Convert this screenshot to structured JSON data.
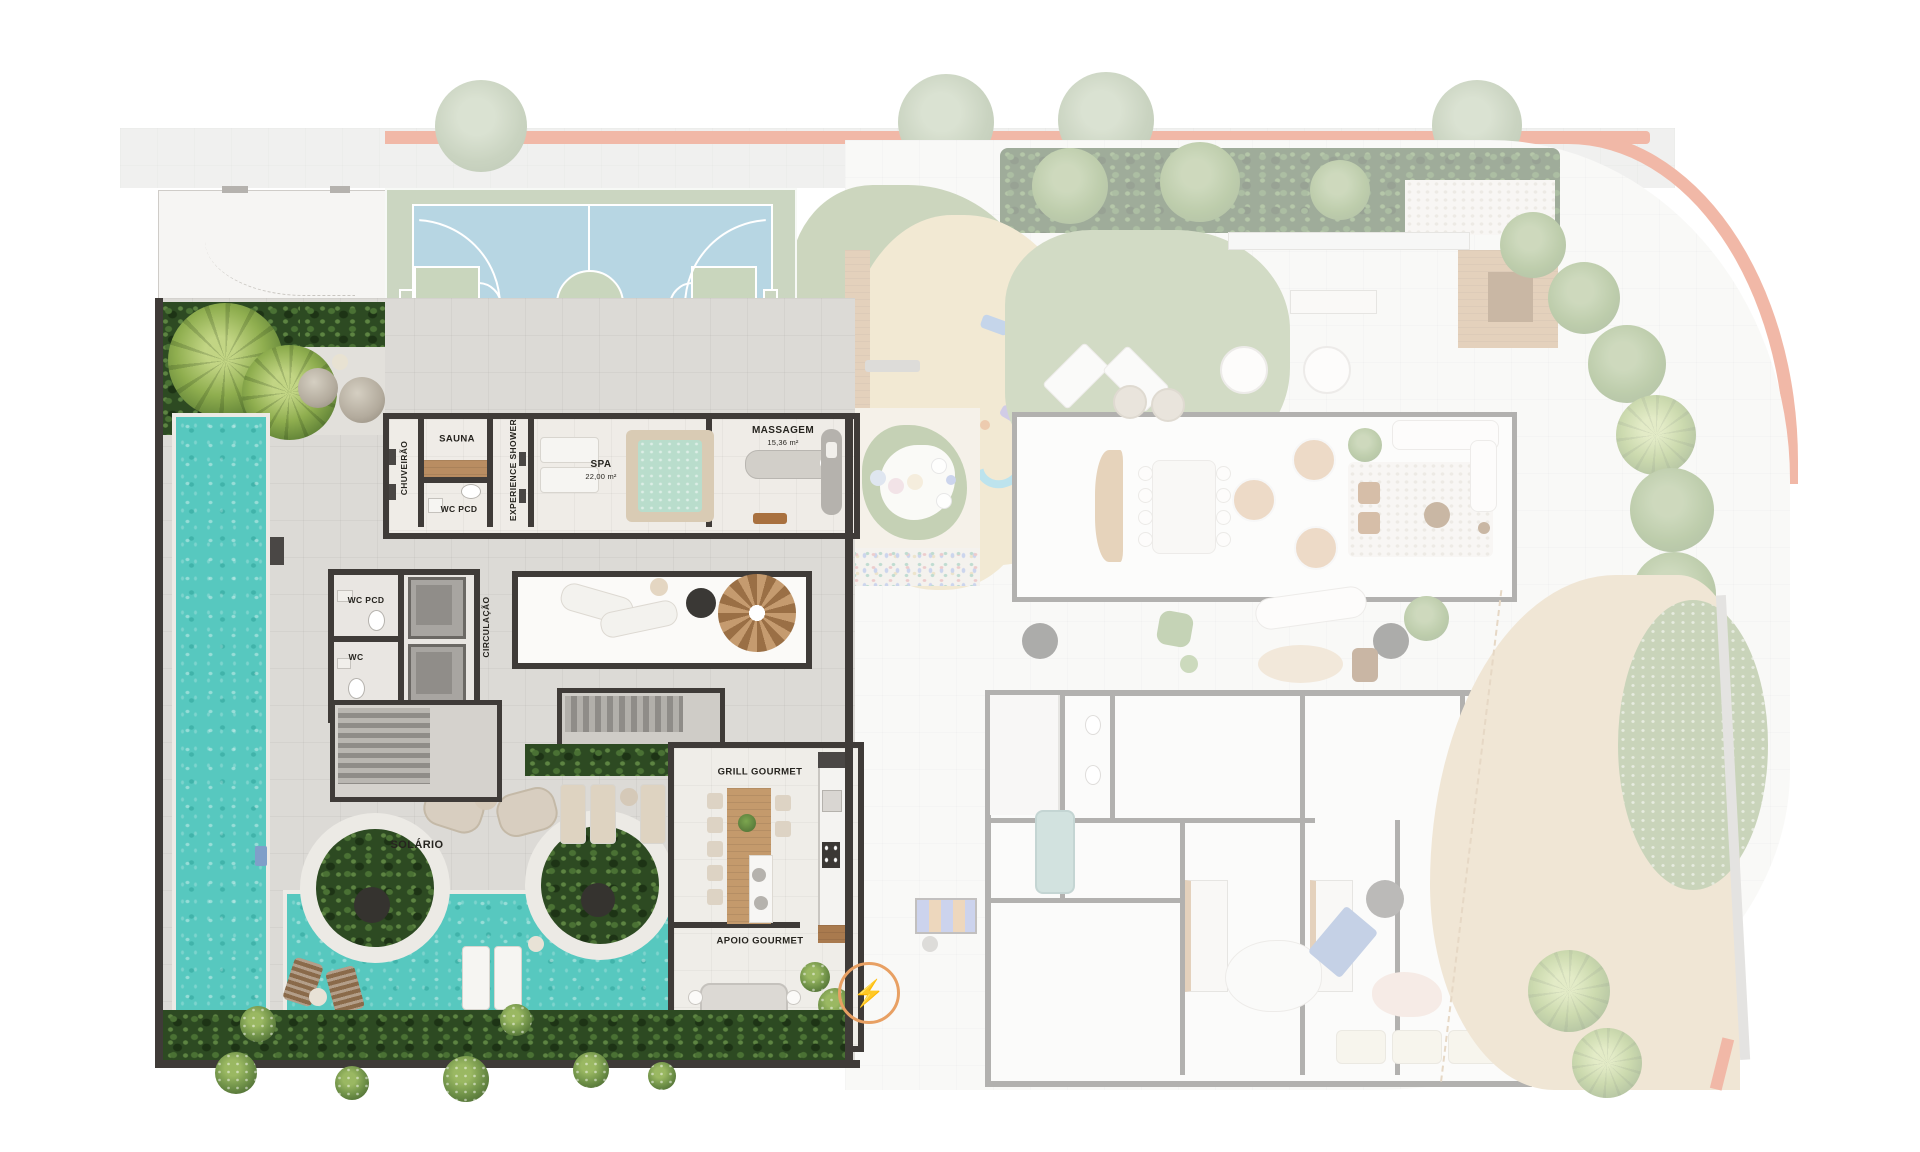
{
  "page": {
    "background": "#ffffff",
    "type": "architectural floor plan — amenities / leisure level, left zone highlighted, right zone faded"
  },
  "plan": {
    "labels": {
      "chuveirao": "CHUVEIRÃO",
      "sauna": "SAUNA",
      "wc_pcd_sauna": "WC PCD",
      "experience_shower": "EXPERIENCE SHOWER",
      "spa": "SPA",
      "spa_area": "22,00 m²",
      "massagem": "MASSAGEM",
      "massagem_area": "15,36 m²",
      "wc_pcd": "WC PCD",
      "wc": "WC",
      "circulacao": "CIRCULAÇÃO",
      "solario": "SOLÁRIO",
      "grill_gourmet": "GRILL  GOURMET",
      "apoio_gourmet": "APOIO GOURMET"
    },
    "icons": {
      "energy": {
        "name": "energy-cycle-icon",
        "glyph": "⚡",
        "color": "#e8a063"
      }
    },
    "features": [
      "sports court (futsal/basketball)",
      "lap pool",
      "leisure pool with round planters",
      "solarium deck with loungers",
      "spiral staircase lounge",
      "two elevators and stairs",
      "dense garden hedges",
      "playground (faded)",
      "apartment interiors (faded)",
      "perimeter garden with palms (faded)"
    ],
    "colors": {
      "pool_water": "#57c8bf",
      "court_blue": "#b7d6e3",
      "court_green": "#c9d6bd",
      "deck": "#dcdad6",
      "wall_dark": "#3f3b38",
      "wood": "#c49a6c",
      "hedge_green": "#2d4a22",
      "salmon_accent": "#e2643d",
      "sand": "#e3cfa0",
      "faded_layer_opacity": "0.45"
    }
  }
}
